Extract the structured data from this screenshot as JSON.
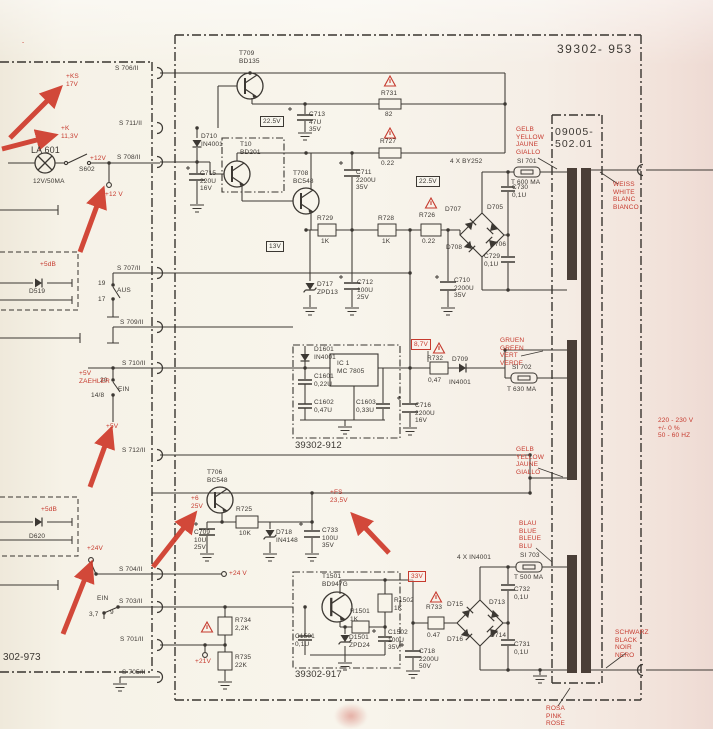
{
  "colors": {
    "paper": "#f6f2e8",
    "ink": "#3c3833",
    "red": "#c63a2e",
    "winding": "#4a3e37"
  },
  "annotations": {
    "arrow_color": "#cf3a2b",
    "arrows": [
      {
        "x1": 10,
        "y1": 138,
        "x2": 58,
        "y2": 90
      },
      {
        "x1": 2,
        "y1": 149,
        "x2": 52,
        "y2": 136
      },
      {
        "x1": 80,
        "y1": 252,
        "x2": 102,
        "y2": 192
      },
      {
        "x1": 90,
        "y1": 487,
        "x2": 110,
        "y2": 432
      },
      {
        "x1": 63,
        "y1": 634,
        "x2": 90,
        "y2": 566
      },
      {
        "x1": 153,
        "y1": 567,
        "x2": 193,
        "y2": 516
      },
      {
        "x1": 389,
        "y1": 553,
        "x2": 355,
        "y2": 517
      }
    ]
  },
  "labels": [
    {
      "n": "main-module-number",
      "t": "39302- 953",
      "x": 557,
      "y": 42,
      "s": 12,
      "ls": 1.5
    },
    {
      "n": "transformer-part-number",
      "t": "09005-\n502.01",
      "x": 555,
      "y": 126,
      "s": 10.5,
      "ls": 1
    },
    {
      "n": "left-module-number",
      "t": "302-973",
      "x": 3,
      "y": 652,
      "s": 10
    },
    {
      "n": "module-912-number",
      "t": "39302-912",
      "x": 295,
      "y": 440,
      "s": 9.5
    },
    {
      "n": "module-917-number",
      "t": "39302-917",
      "x": 295,
      "y": 669,
      "s": 9.5
    },
    {
      "n": "t709-ref",
      "t": "T709\nBD135",
      "x": 239,
      "y": 50
    },
    {
      "n": "r731-ref",
      "t": "R731",
      "x": 381,
      "y": 90
    },
    {
      "n": "r731-val",
      "t": "82",
      "x": 385,
      "y": 111
    },
    {
      "n": "c713-ref",
      "t": "C713\n47U\n35V",
      "x": 309,
      "y": 111
    },
    {
      "n": "test-22v5-a",
      "t": "22.5V",
      "x": 260,
      "y": 116,
      "b": "black"
    },
    {
      "n": "d710-ref",
      "t": "D710\nIN4001",
      "x": 201,
      "y": 133
    },
    {
      "n": "c715-ref",
      "t": "C715\n220U\n16V",
      "x": 200,
      "y": 170
    },
    {
      "n": "t10-ref",
      "t": "T10\nBD201",
      "x": 240,
      "y": 141
    },
    {
      "n": "t708-ref",
      "t": "T708\nBC548",
      "x": 293,
      "y": 170
    },
    {
      "n": "r727-ref",
      "t": "R727",
      "x": 380,
      "y": 138
    },
    {
      "n": "r727-val",
      "t": "0.22",
      "x": 381,
      "y": 160
    },
    {
      "n": "test-22v5-b",
      "t": "22.5V",
      "x": 416,
      "y": 176,
      "b": "black"
    },
    {
      "n": "c711-ref",
      "t": "C711\n2200U\n35V",
      "x": 356,
      "y": 169
    },
    {
      "n": "r729-ref",
      "t": "R729",
      "x": 317,
      "y": 215
    },
    {
      "n": "r729-val",
      "t": "1K",
      "x": 321,
      "y": 238
    },
    {
      "n": "r728-ref",
      "t": "R728",
      "x": 378,
      "y": 215
    },
    {
      "n": "r728-val",
      "t": "1K",
      "x": 382,
      "y": 238
    },
    {
      "n": "r726-ref",
      "t": "R726",
      "x": 419,
      "y": 212
    },
    {
      "n": "r726-val",
      "t": "0.22",
      "x": 422,
      "y": 238
    },
    {
      "n": "test-13v",
      "t": "13V",
      "x": 266,
      "y": 241,
      "b": "black"
    },
    {
      "n": "d717-ref",
      "t": "D717\nZPD13",
      "x": 317,
      "y": 281
    },
    {
      "n": "c712-ref",
      "t": "C712\n100U\n25V",
      "x": 357,
      "y": 279
    },
    {
      "n": "c710-ref",
      "t": "C710\n2200U\n35V",
      "x": 454,
      "y": 277
    },
    {
      "n": "bridge1-type",
      "t": "4 X BY252",
      "x": 450,
      "y": 158
    },
    {
      "n": "d707-ref",
      "t": "D707",
      "x": 445,
      "y": 206
    },
    {
      "n": "d705-ref",
      "t": "D705",
      "x": 487,
      "y": 204
    },
    {
      "n": "d708-ref",
      "t": "D708",
      "x": 446,
      "y": 244
    },
    {
      "n": "d706-ref",
      "t": "D706",
      "x": 490,
      "y": 241
    },
    {
      "n": "si701-ref",
      "t": "SI 701",
      "x": 517,
      "y": 158
    },
    {
      "n": "si701-val",
      "t": "T 600 MA",
      "x": 511,
      "y": 179
    },
    {
      "n": "c730-ref",
      "t": "C730\n0,1U",
      "x": 512,
      "y": 184
    },
    {
      "n": "c729-ref",
      "t": "C729\n0,1U",
      "x": 484,
      "y": 253
    },
    {
      "n": "wire-gelb-1",
      "t": "GELB\nYELLOW\nJAUNE\nGIALLO",
      "x": 516,
      "y": 126,
      "c": "red"
    },
    {
      "n": "wire-weiss",
      "t": "WEISS\nWHITE\nBLANC\nBIANCO",
      "x": 613,
      "y": 181,
      "c": "red"
    },
    {
      "n": "wire-gruen",
      "t": "GRUEN\nGREEN\nVERT\nVERDE",
      "x": 500,
      "y": 337,
      "c": "red"
    },
    {
      "n": "si702-ref",
      "t": "SI 702",
      "x": 512,
      "y": 364
    },
    {
      "n": "si702-val",
      "t": "T 630 MA",
      "x": 507,
      "y": 386
    },
    {
      "n": "wire-gelb-2",
      "t": "GELB\nYELLOW\nJAUNE\nGIALLO",
      "x": 516,
      "y": 446,
      "c": "red"
    },
    {
      "n": "mains-rating",
      "t": "220 - 230 V\n+/- 0 %\n50 - 60 HZ",
      "x": 658,
      "y": 417,
      "c": "red"
    },
    {
      "n": "wire-blau",
      "t": "BLAU\nBLUE\nBLEUE\nBLU",
      "x": 519,
      "y": 520,
      "c": "red"
    },
    {
      "n": "si703-ref",
      "t": "SI 703",
      "x": 520,
      "y": 552
    },
    {
      "n": "si703-val",
      "t": "T 500 MA",
      "x": 514,
      "y": 574
    },
    {
      "n": "bridge2-type",
      "t": "4 X IN4001",
      "x": 457,
      "y": 554
    },
    {
      "n": "d715-ref",
      "t": "D715",
      "x": 447,
      "y": 601
    },
    {
      "n": "d713-ref",
      "t": "D713",
      "x": 489,
      "y": 599
    },
    {
      "n": "d716-ref",
      "t": "D716",
      "x": 447,
      "y": 636
    },
    {
      "n": "d714-ref",
      "t": "D714",
      "x": 490,
      "y": 632
    },
    {
      "n": "c732-ref",
      "t": "C732\n0,1U",
      "x": 514,
      "y": 586
    },
    {
      "n": "c731-ref",
      "t": "C731\n0,1U",
      "x": 514,
      "y": 641
    },
    {
      "n": "wire-schwarz",
      "t": "SCHWARZ\nBLACK\nNOIR\nNERO",
      "x": 615,
      "y": 629,
      "c": "red"
    },
    {
      "n": "wire-rosa",
      "t": "ROSA\nPINK\nROSE",
      "x": 546,
      "y": 705,
      "c": "red"
    },
    {
      "n": "test-8v7",
      "t": "8,7V",
      "x": 411,
      "y": 339,
      "b": "red",
      "c": "red"
    },
    {
      "n": "ic1-ref",
      "t": "IC 1\nMC 7805",
      "x": 337,
      "y": 360
    },
    {
      "n": "d1601-ref",
      "t": "D1601\nIN4001",
      "x": 314,
      "y": 346
    },
    {
      "n": "c1601-ref",
      "t": "C1601\n0,22U",
      "x": 314,
      "y": 373
    },
    {
      "n": "c1602-ref",
      "t": "C1602\n0,47U",
      "x": 314,
      "y": 399
    },
    {
      "n": "c1603-ref",
      "t": "C1603\n0,33U",
      "x": 356,
      "y": 399
    },
    {
      "n": "r732-ref",
      "t": "R732",
      "x": 427,
      "y": 355
    },
    {
      "n": "r732-val",
      "t": "0,47",
      "x": 428,
      "y": 377
    },
    {
      "n": "d709-ref",
      "t": "D709",
      "x": 452,
      "y": 356
    },
    {
      "n": "d709-val",
      "t": "IN4001",
      "x": 449,
      "y": 379
    },
    {
      "n": "c716-ref",
      "t": "C716\n2200U\n16V",
      "x": 415,
      "y": 402
    },
    {
      "n": "t706-ref",
      "t": "T706\nBC548",
      "x": 207,
      "y": 469
    },
    {
      "n": "r725-ref",
      "t": "R725",
      "x": 236,
      "y": 506
    },
    {
      "n": "r725-val",
      "t": "10K",
      "x": 239,
      "y": 530
    },
    {
      "n": "c709-ref",
      "t": "C709\n10U\n25V",
      "x": 194,
      "y": 529
    },
    {
      "n": "d718-ref",
      "t": "D718\nIN4148",
      "x": 276,
      "y": 529
    },
    {
      "n": "c733-ref",
      "t": "C733\n100U\n35V",
      "x": 322,
      "y": 527
    },
    {
      "n": "t1501-ref",
      "t": "T1501\nBD947G",
      "x": 322,
      "y": 573
    },
    {
      "n": "r1501-ref",
      "t": "R1501\n1K",
      "x": 350,
      "y": 608
    },
    {
      "n": "r1502-ref",
      "t": "R1502\n1K",
      "x": 394,
      "y": 597
    },
    {
      "n": "c1501-ref",
      "t": "C1501\n0,1U",
      "x": 295,
      "y": 633
    },
    {
      "n": "d1501-ref",
      "t": "D1501\nZPD24",
      "x": 349,
      "y": 634
    },
    {
      "n": "c1502-ref",
      "t": "C1502\n100U\n35V",
      "x": 388,
      "y": 629
    },
    {
      "n": "test-33v",
      "t": "33V",
      "x": 408,
      "y": 571,
      "b": "red",
      "c": "red"
    },
    {
      "n": "r733-ref",
      "t": "R733",
      "x": 426,
      "y": 604
    },
    {
      "n": "r733-val",
      "t": "0.47",
      "x": 427,
      "y": 632
    },
    {
      "n": "c718-ref",
      "t": "C718\n2200U\n50V",
      "x": 419,
      "y": 648
    },
    {
      "n": "r734-ref",
      "t": "R734\n2,2K",
      "x": 235,
      "y": 617
    },
    {
      "n": "r735-ref",
      "t": "R735\n22K",
      "x": 235,
      "y": 654
    },
    {
      "n": "conn-s706",
      "t": "S 706/II",
      "x": 115,
      "y": 65
    },
    {
      "n": "conn-s711",
      "t": "S 711/II",
      "x": 119,
      "y": 120
    },
    {
      "n": "conn-s708",
      "t": "S 708/II",
      "x": 117,
      "y": 154
    },
    {
      "n": "conn-s707",
      "t": "S 707/II",
      "x": 117,
      "y": 265
    },
    {
      "n": "conn-s709",
      "t": "S 709/II",
      "x": 120,
      "y": 319
    },
    {
      "n": "conn-s710",
      "t": "S 710/II",
      "x": 122,
      "y": 360
    },
    {
      "n": "conn-s712",
      "t": "S 712/II",
      "x": 122,
      "y": 447
    },
    {
      "n": "conn-s704",
      "t": "S 704/II",
      "x": 119,
      "y": 566
    },
    {
      "n": "conn-s703",
      "t": "S 703/II",
      "x": 119,
      "y": 598
    },
    {
      "n": "conn-s701",
      "t": "S 701/II",
      "x": 120,
      "y": 636
    },
    {
      "n": "conn-s705",
      "t": "S 705/II",
      "x": 122,
      "y": 669
    },
    {
      "n": "lamp-ref",
      "t": "LA 601",
      "x": 31,
      "y": 145,
      "s": 9
    },
    {
      "n": "lamp-rating",
      "t": "12V/50MA",
      "x": 33,
      "y": 178
    },
    {
      "n": "s602-ref",
      "t": "S602",
      "x": 79,
      "y": 166
    },
    {
      "n": "sw707-pin19",
      "t": "19",
      "x": 98,
      "y": 280
    },
    {
      "n": "sw707-pin17",
      "t": "17",
      "x": 98,
      "y": 296
    },
    {
      "n": "sw707-aus",
      "t": "AUS",
      "x": 117,
      "y": 287
    },
    {
      "n": "sw710-pin20",
      "t": "20",
      "x": 100,
      "y": 377
    },
    {
      "n": "sw710-ein",
      "t": "EIN",
      "x": 118,
      "y": 386
    },
    {
      "n": "sw710-pin148",
      "t": "14/8",
      "x": 91,
      "y": 392
    },
    {
      "n": "sw703-ein",
      "t": "EIN",
      "x": 97,
      "y": 595
    },
    {
      "n": "sw703-pin37",
      "t": "3,7",
      "x": 89,
      "y": 611
    },
    {
      "n": "sw703-pin9",
      "t": "9",
      "x": 110,
      "y": 609
    },
    {
      "n": "d519-ref",
      "t": "D519",
      "x": 29,
      "y": 288
    },
    {
      "n": "d519-gain",
      "t": "+5dB",
      "x": 40,
      "y": 261,
      "c": "red"
    },
    {
      "n": "d620-ref",
      "t": "D620",
      "x": 29,
      "y": 533
    },
    {
      "n": "d620-gain",
      "t": "+5dB",
      "x": 41,
      "y": 506,
      "c": "red"
    },
    {
      "n": "ann-ks",
      "t": "+KS\n17V",
      "x": 66,
      "y": 73,
      "c": "red"
    },
    {
      "n": "ann-k",
      "t": "+K\n11,3V",
      "x": 61,
      "y": 125,
      "c": "red"
    },
    {
      "n": "ann-12v-a",
      "t": "+12V",
      "x": 90,
      "y": 155,
      "c": "red"
    },
    {
      "n": "ann-12v-b",
      "t": "+12 V",
      "x": 105,
      "y": 191,
      "c": "red"
    },
    {
      "n": "ann-5v-zaehler",
      "t": "+5V\nZAEHLER",
      "x": 79,
      "y": 370,
      "c": "red"
    },
    {
      "n": "ann-5v",
      "t": "+5V",
      "x": 106,
      "y": 423,
      "c": "red"
    },
    {
      "n": "ann-24v-a",
      "t": "+24V",
      "x": 87,
      "y": 545,
      "c": "red"
    },
    {
      "n": "ann-24v-b",
      "t": "+24 V",
      "x": 229,
      "y": 570,
      "c": "red"
    },
    {
      "n": "ann-21v",
      "t": "+21V",
      "x": 195,
      "y": 658,
      "c": "red"
    },
    {
      "n": "ann-6v",
      "t": "+6\n25V",
      "x": 191,
      "y": 495,
      "c": "red"
    },
    {
      "n": "ann-fs",
      "t": "+FS\n23,5V",
      "x": 330,
      "y": 489,
      "c": "red"
    },
    {
      "n": "ann-tick",
      "t": "-",
      "x": 22,
      "y": 39,
      "c": "red"
    }
  ]
}
